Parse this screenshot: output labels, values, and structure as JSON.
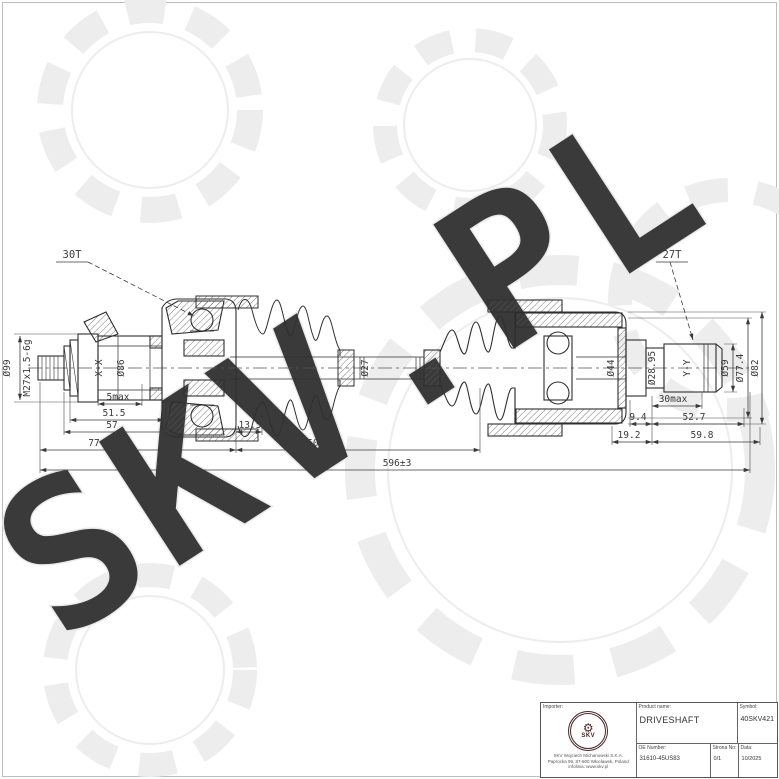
{
  "watermark": {
    "text": "SKV.PL"
  },
  "drawing": {
    "callout_left": "30T",
    "callout_right": "27T",
    "thread_label": "M27x1.5-6g",
    "dia_99": "Ø99",
    "section_left": "X-X",
    "dia_86": "Ø86",
    "dia_27": "Ø27",
    "dia_44": "Ø44",
    "dia_2895": "Ø28.95",
    "section_right": "Y-Y",
    "dia_59": "Ø59",
    "dia_774": "Ø77.4",
    "dia_82": "Ø82",
    "dim_5max": "5max",
    "dim_515": "51.5",
    "dim_57": "57",
    "dim_135": "13.5",
    "dim_77": "77",
    "dim_150": "150",
    "dim_30max": "30max",
    "dim_94": "9.4",
    "dim_527": "52.7",
    "dim_192": "19.2",
    "dim_598": "59.8",
    "dim_total": "596±3"
  },
  "title_block": {
    "importer_label": "Importer:",
    "logo_gear_icon": "⚙",
    "logo_text": "SKV",
    "address_line1": "SKV Wojciech Michanowski S.K.A.",
    "address_line2": "Paprocka 99, 87-800 Włocławek, Poland",
    "address_line3": "infolinia: www.skv.pl",
    "product_label": "Product name:",
    "product_value": "DRIVESHAFT",
    "symbol_label": "Symbol:",
    "symbol_value": "40SKV421",
    "oe_label": "OE Number:",
    "oe_value": "31610-45US83",
    "page_label": "Strona No:",
    "page_value": "0/1",
    "date_label": "Data:",
    "date_value": "10/2025"
  }
}
